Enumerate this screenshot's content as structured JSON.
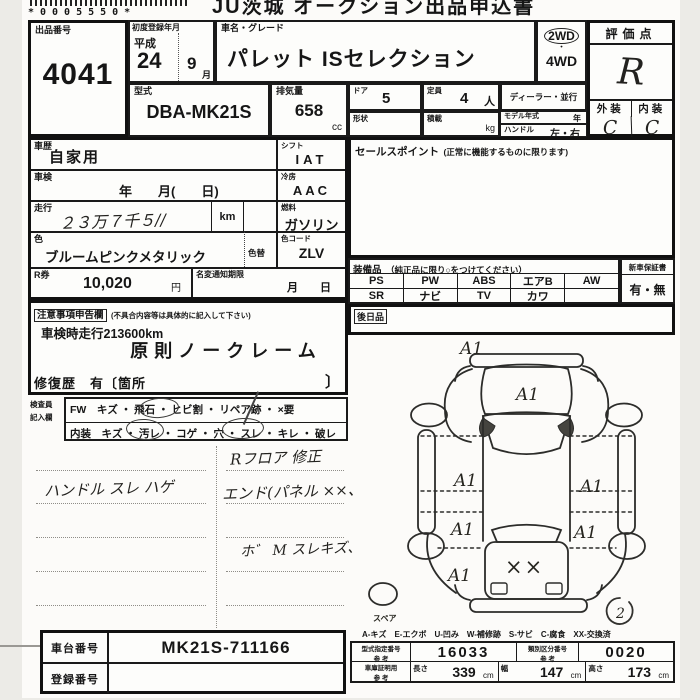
{
  "header": {
    "barcode_digits": "*0005550*",
    "title": "JU茨城 オークション出品申込書"
  },
  "lot": {
    "label": "出品番号",
    "number": "4041"
  },
  "first_reg": {
    "label": "初度登録年月",
    "era": "平成",
    "year": "24",
    "month": "9",
    "month_unit": "月"
  },
  "name": {
    "label": "車名・グレード",
    "value": "パレット ISセレクション"
  },
  "drive": {
    "wd2": "2WD",
    "dot": "・",
    "wd4": "4WD"
  },
  "spec": {
    "model_label": "型式",
    "model": "DBA-MK21S",
    "disp_label": "排気量",
    "disp": "658",
    "disp_unit": "cc",
    "door_label": "ドア",
    "door": "5",
    "capacity_label": "定員",
    "capacity": "4",
    "capacity_unit": "人",
    "shape_label": "形状",
    "load_label": "積載",
    "load_unit": "kg",
    "dealer": "ディーラー・並行",
    "model_year_label": "モデル年式",
    "model_year_unit": "年",
    "handle_label": "ハンドル",
    "handle": "左・右"
  },
  "eval": {
    "title": "評価点",
    "score": "R",
    "ext_label": "外装",
    "int_label": "内装",
    "ext": "C",
    "int": "C"
  },
  "history": {
    "history_label": "車歴",
    "history": "自家用",
    "shift_label": "シフト",
    "shift": "IAT",
    "shaken_label": "車検",
    "shaken": "年　　月(　　日)",
    "ac_label": "冷房",
    "ac": "AAC",
    "mileage_label": "走行",
    "mileage_hand": "２３万７千５//",
    "km": "km",
    "fuel_label": "燃料",
    "fuel": "ガソリン",
    "color_label": "色",
    "color": "ブルームピンクメタリック",
    "recolor_label": "色替",
    "ccode_label": "色コード",
    "ccode": "ZLV",
    "rticket_label": "R券",
    "rticket": "10,020",
    "yen": "円",
    "rename_label": "名変通知期限",
    "rename": "月　　日"
  },
  "sales": {
    "title": "セールスポイント",
    "title_note": "(正常に機能するものに限ります)"
  },
  "equip": {
    "title": "装備品",
    "title_note": "（純正品に限り○をつけてください）",
    "rows": [
      [
        "PS",
        "PW",
        "ABS",
        "エアB",
        "AW"
      ],
      [
        "SR",
        "ナビ",
        "TV",
        "カワ",
        ""
      ]
    ],
    "warranty_label": "新車保証書",
    "warranty": "有・無",
    "later_label": "後日品"
  },
  "notice": {
    "title": "注意事項申告欄",
    "title_note": "(不具合内容等は具体的に記入して下さい)",
    "line1": "車検時走行213600km",
    "line2": "原則ノークレーム",
    "repair": "修復歴　有〔箇所",
    "bracket": "〕"
  },
  "inspector": {
    "label1": "検査員",
    "label2": "記入欄",
    "fw_row": "FW　キズ ・ 飛石 ・ ヒビ割 ・ リペア跡 ・ ×要",
    "int_row": "内装　キズ ・ 汚レ ・ コゲ ・ 穴 ・ スレ ・ キレ ・ 破レ",
    "circled_words": [
      "飛石",
      "汚レ",
      "スレ"
    ]
  },
  "notes": {
    "left1": "ハンドル スレ ハゲ",
    "right1": "Rフロア 修正",
    "right2": "エンド(パネル ××、",
    "right3": "ホ゛ M スレキズ、"
  },
  "diagram": {
    "mark": "A1",
    "xx": "××",
    "spare": "スペア",
    "note2": "2",
    "legend": "A-キズ　E-エクボ　U-凹み　W-補修跡　S-サビ　C-腐食　XX-交換済"
  },
  "bottom": {
    "chassis_label": "車台番号",
    "chassis": "MK21S-711166",
    "plate_label": "登録番号",
    "plate": "",
    "type_label": "型式指定番号",
    "ref": "参 考",
    "type_no": "16033",
    "class_label": "類別区分番号",
    "class_no": "0020",
    "garage_label": "車庫証明用",
    "len_label": "長さ",
    "len": "339",
    "wid_label": "幅",
    "wid": "147",
    "hei_label": "高さ",
    "hei": "173",
    "cm": "cm"
  }
}
